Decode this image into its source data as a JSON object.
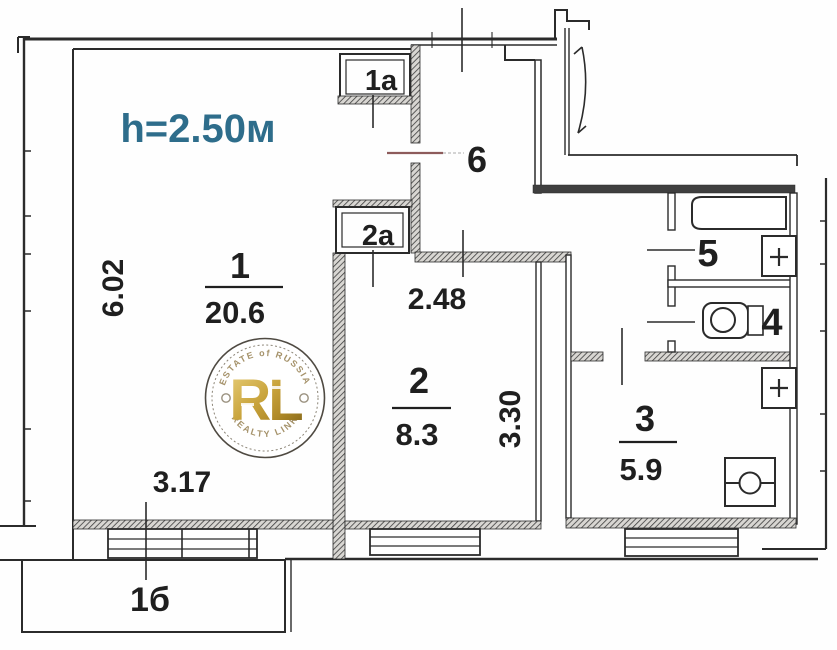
{
  "plan": {
    "height_note": "h=2.50м",
    "labels": {
      "room1": {
        "number": "1",
        "area": "20.6"
      },
      "room2": {
        "number": "2",
        "area": "8.3"
      },
      "room3": {
        "number": "3",
        "area": "5.9"
      },
      "room4": {
        "number": "4"
      },
      "room5": {
        "number": "5"
      },
      "room6": {
        "number": "6"
      },
      "closet1a": {
        "number": "1a"
      },
      "closet2a": {
        "number": "2a"
      },
      "balcony": {
        "number": "1б"
      }
    },
    "dimensions": {
      "room1_depth": "6.02",
      "room1_width": "3.17",
      "room2_width": "2.48",
      "room2_depth": "3.30"
    },
    "colors": {
      "height_note": "#2e6d8b",
      "line": "#2b2b2b",
      "door_mark": "#8d5b5b"
    }
  },
  "watermark": {
    "monogram": "RL",
    "arc_top": "ESTATE of RUSSIA",
    "arc_bottom": "REALTY LINK"
  }
}
